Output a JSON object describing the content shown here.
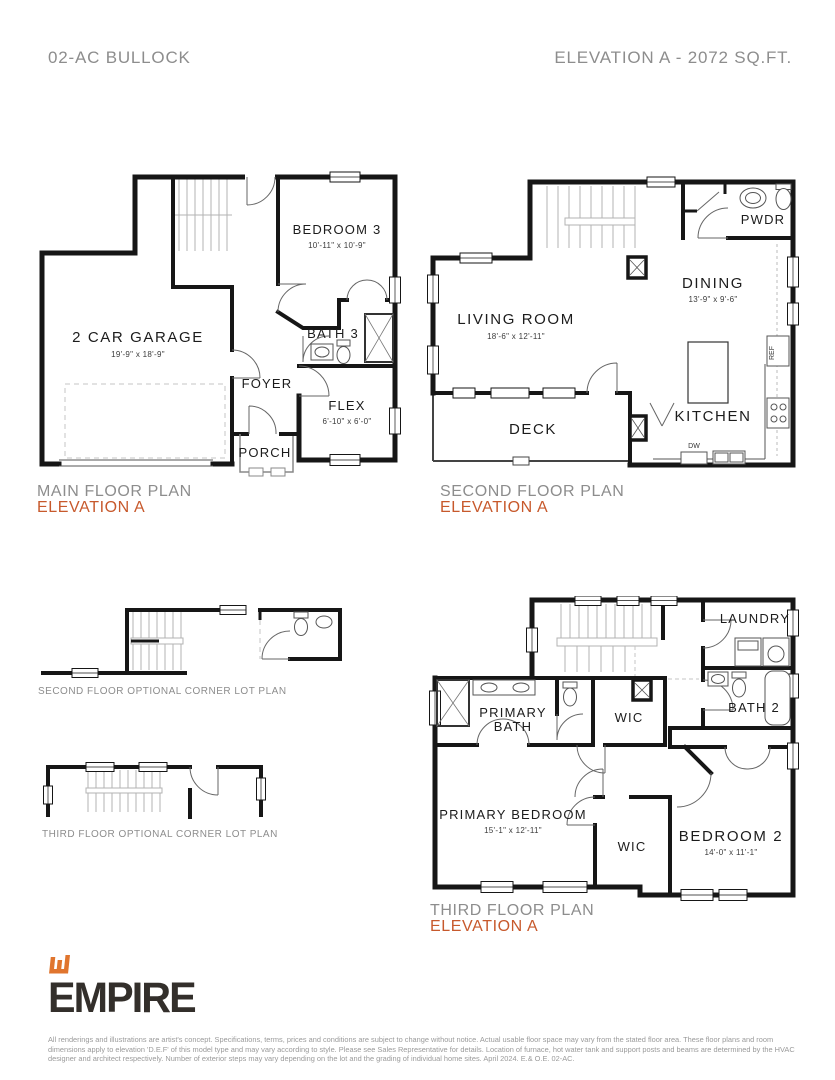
{
  "header": {
    "model": "02-AC BULLOCK",
    "elevation": "ELEVATION A - 2072 SQ.FT."
  },
  "plans": {
    "main_floor": {
      "title": "MAIN FLOOR PLAN",
      "subtitle": "ELEVATION A",
      "rooms": {
        "garage": {
          "name": "2 CAR GARAGE",
          "dims": "19'-9\" x 18'-9\""
        },
        "bedroom3": {
          "name": "BEDROOM 3",
          "dims": "10'-11\" x 10'-9\""
        },
        "bath3": {
          "name": "BATH 3"
        },
        "foyer": {
          "name": "FOYER"
        },
        "flex": {
          "name": "FLEX",
          "dims": "6'-10\" x 6'-0\""
        },
        "porch": {
          "name": "PORCH"
        }
      }
    },
    "second_floor": {
      "title": "SECOND FLOOR PLAN",
      "subtitle": "ELEVATION A",
      "rooms": {
        "living": {
          "name": "LIVING ROOM",
          "dims": "18'-6\" x 12'-11\""
        },
        "dining": {
          "name": "DINING",
          "dims": "13'-9\" x 9'-6\""
        },
        "kitchen": {
          "name": "KITCHEN"
        },
        "deck": {
          "name": "DECK"
        },
        "pwdr": {
          "name": "PWDR"
        },
        "appliances": {
          "dw": "DW",
          "ref": "REF"
        }
      }
    },
    "third_floor": {
      "title": "THIRD FLOOR PLAN",
      "subtitle": "ELEVATION A",
      "rooms": {
        "primary_bedroom": {
          "name": "PRIMARY BEDROOM",
          "dims": "15'-1\" x 12'-11\""
        },
        "primary_bath": {
          "line1": "PRIMARY",
          "line2": "BATH"
        },
        "wic_upper": {
          "name": "WIC"
        },
        "wic_lower": {
          "name": "WIC"
        },
        "bath2": {
          "name": "BATH 2"
        },
        "laundry": {
          "name": "LAUNDRY"
        },
        "bedroom2": {
          "name": "BEDROOM 2",
          "dims": "14'-0\" x 11'-1\""
        }
      }
    },
    "second_floor_optional": {
      "title": "SECOND FLOOR OPTIONAL CORNER LOT PLAN"
    },
    "third_floor_optional": {
      "title": "THIRD FLOOR OPTIONAL CORNER LOT PLAN"
    }
  },
  "logo": {
    "brand": "EMPIRE"
  },
  "disclaimer": {
    "text": "All renderings and illustrations are artist's concept. Specifications, terms, prices and conditions are subject to change without notice. Actual usable floor space may vary from the stated floor area. These floor plans and room dimensions apply to elevation 'D.E.F' of this model type and may vary according to style. Please see Sales Representative for details. Location of furnace, hot water tank and support posts and beams are determined by the HVAC designer and architect respectively. Number of exterior steps may vary depending on the lot and the grading of individual home sites. April 2024. E.& O.E. 02-AC."
  },
  "colors": {
    "accent": "#C7592C",
    "muted": "#8D8D8D",
    "wall": "#161616"
  }
}
